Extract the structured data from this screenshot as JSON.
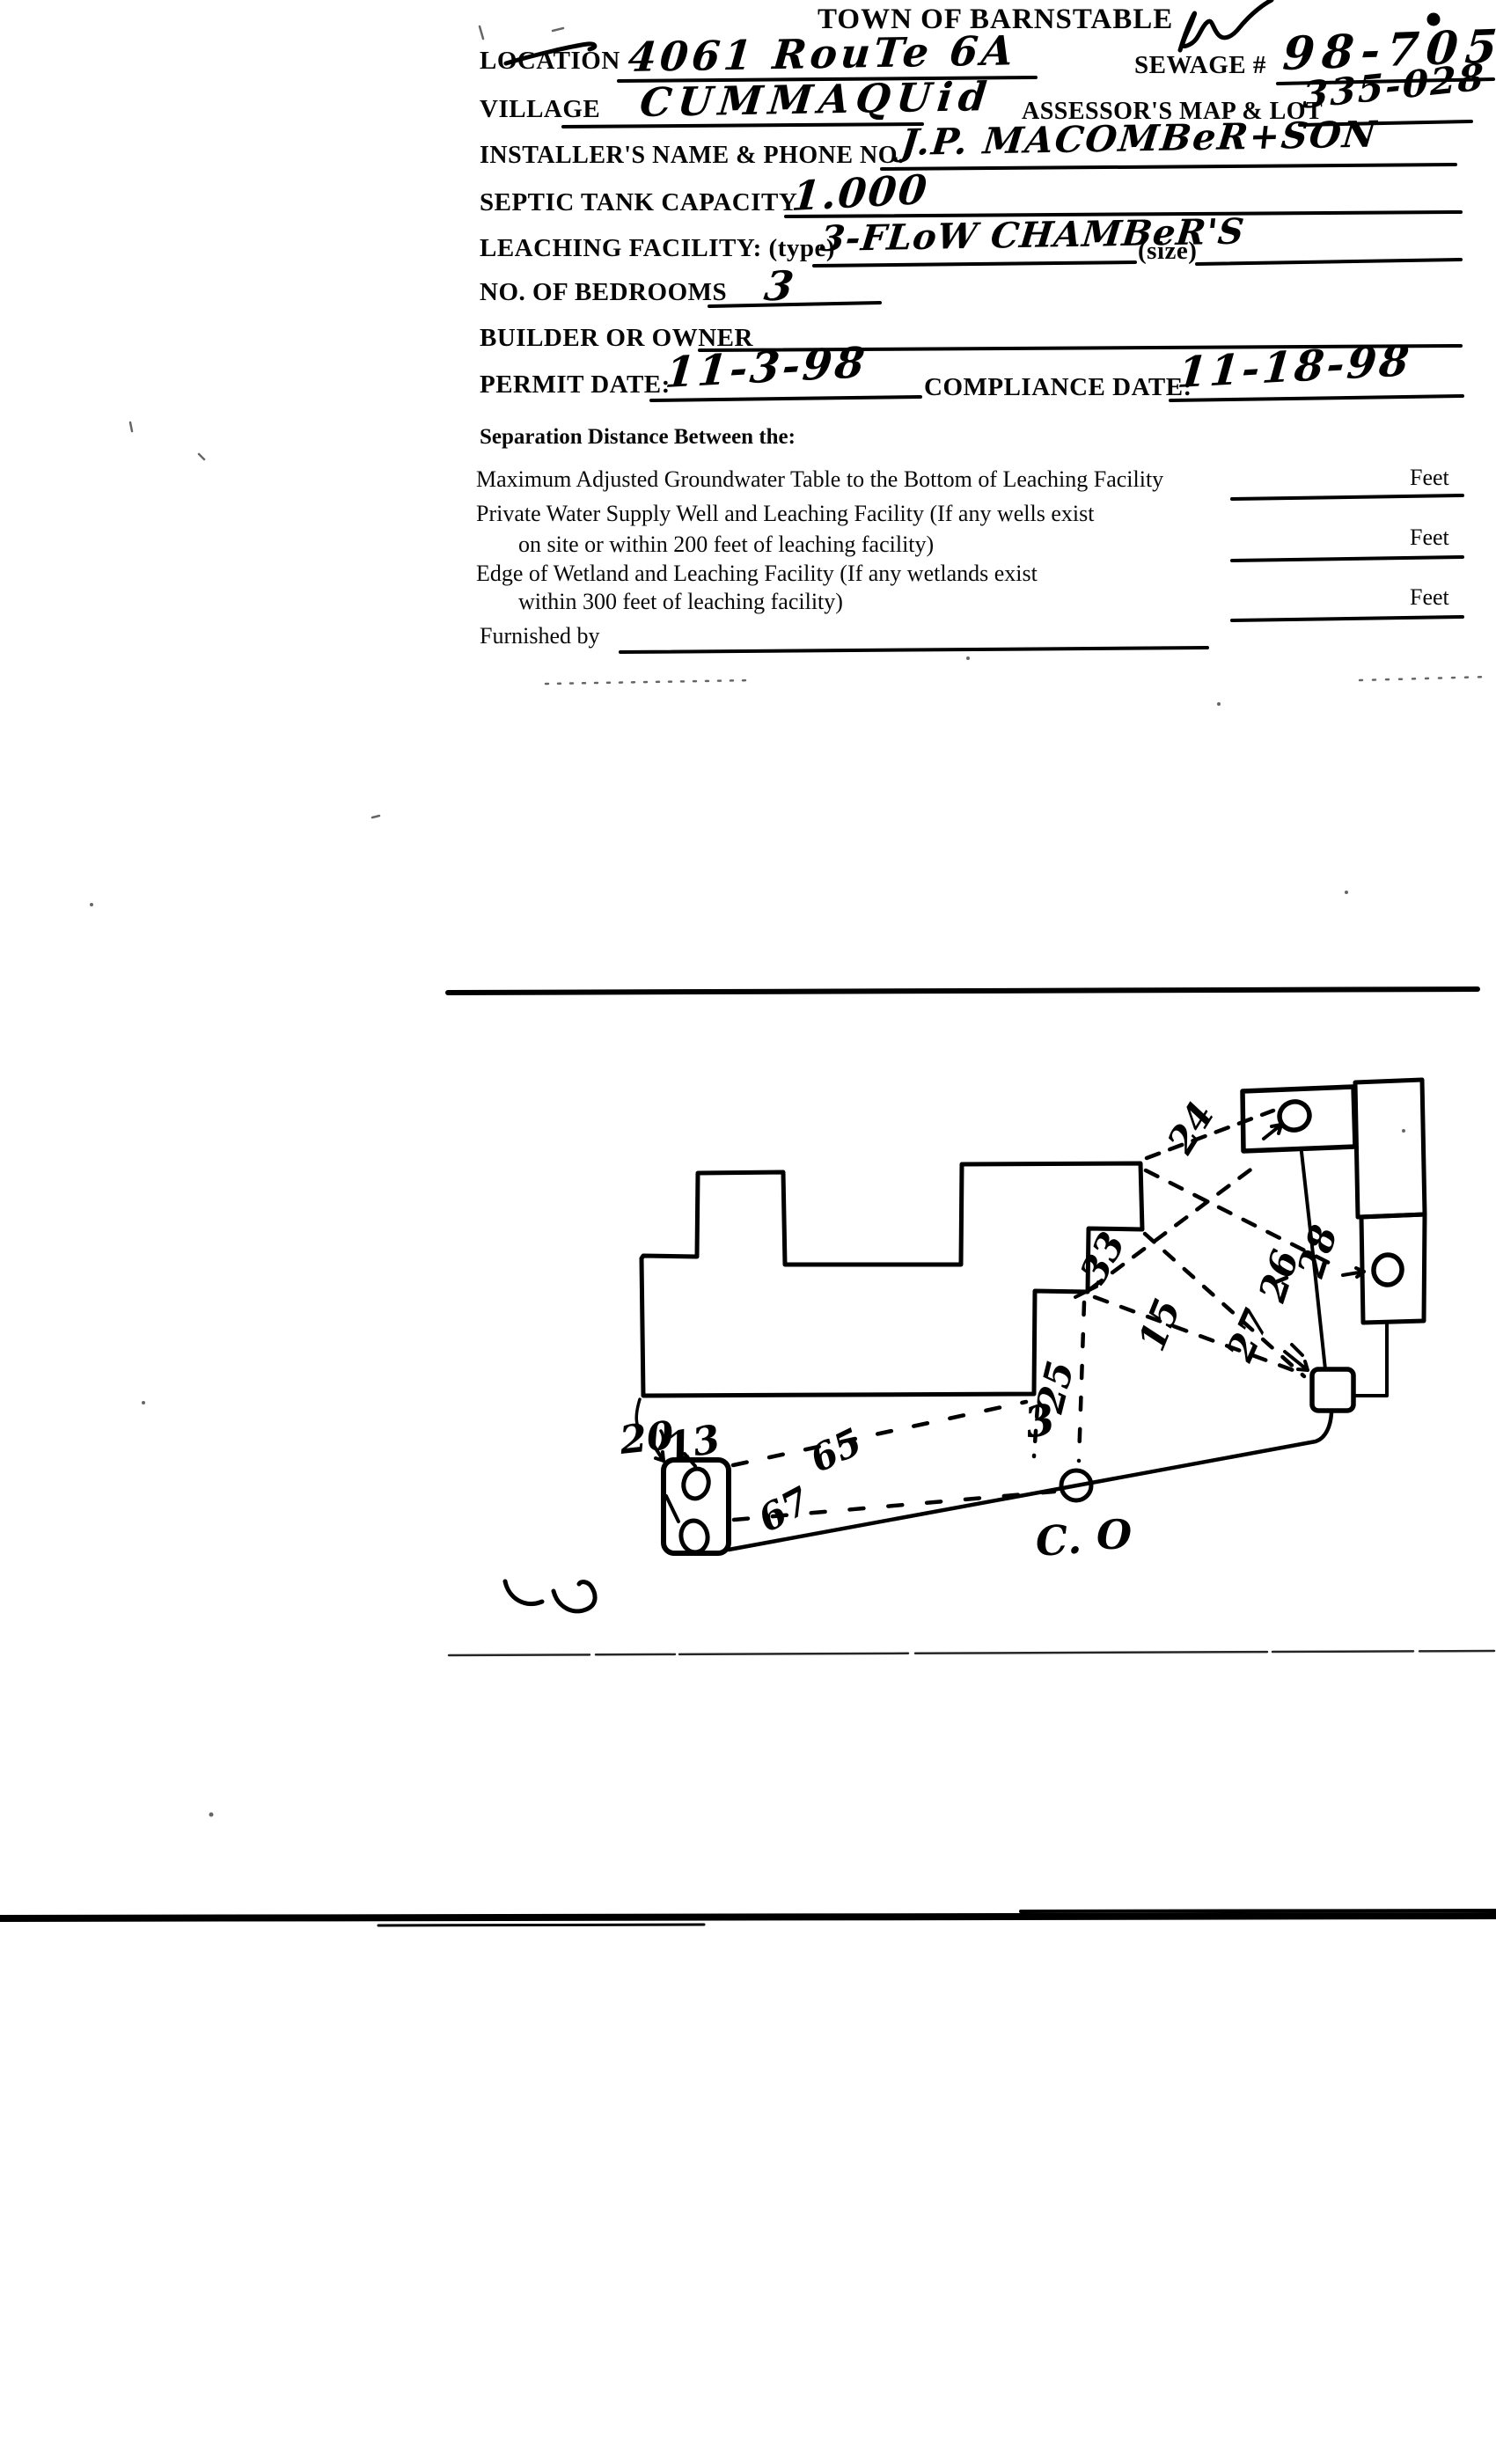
{
  "form": {
    "title": "TOWN OF BARNSTABLE",
    "rows": {
      "location": {
        "label": "LOCATION",
        "value": "4061  RouTe 6A"
      },
      "sewage": {
        "label": "SEWAGE #",
        "value": "98-705"
      },
      "village": {
        "label": "VILLAGE",
        "value": "CUMMAQUid"
      },
      "map_lot": {
        "label": "ASSESSOR'S MAP & LOT",
        "value": "335-028"
      },
      "installer": {
        "label": "INSTALLER'S NAME & PHONE NO.",
        "value": "J.P. MACOMBeR+SON"
      },
      "septic": {
        "label": "SEPTIC TANK CAPACITY",
        "value": "1.000"
      },
      "leaching": {
        "label": "LEACHING FACILITY: (type)",
        "value": "3-FLoW CHAMBeR'S",
        "size_label": "(size)",
        "size_value": ""
      },
      "bedrooms": {
        "label": "NO. OF BEDROOMS",
        "value": "3"
      },
      "builder": {
        "label": "BUILDER OR OWNER",
        "value": ""
      },
      "permit": {
        "label": "PERMIT DATE:",
        "value": "11-3-98"
      },
      "compliance": {
        "label": "COMPLIANCE DATE:",
        "value": "11-18-98"
      }
    },
    "separation": {
      "heading": "Separation Distance Between the:",
      "items": [
        {
          "line1": "Maximum Adjusted Groundwater Table to the Bottom of Leaching Facility",
          "line2": "",
          "value": "",
          "unit": "Feet"
        },
        {
          "line1": "Private Water Supply Well and Leaching Facility  (If any wells exist",
          "line2": "on site or within 200 feet of leaching facility)",
          "value": "",
          "unit": "Feet"
        },
        {
          "line1": "Edge of Wetland and Leaching Facility (If any wetlands exist",
          "line2": "within 300 feet of leaching facility)",
          "value": "",
          "unit": "Feet"
        }
      ],
      "furnished_label": "Furnished by"
    }
  },
  "sketch": {
    "labels": {
      "n20": "20",
      "n13": "13",
      "n65": "65",
      "n67": "67",
      "n25": "25",
      "n3": "3",
      "n33": "33",
      "n15": "15",
      "n27": "27",
      "n26": "26",
      "n28": "28",
      "n24": "24",
      "co1": "C.",
      "co2": "O"
    }
  }
}
